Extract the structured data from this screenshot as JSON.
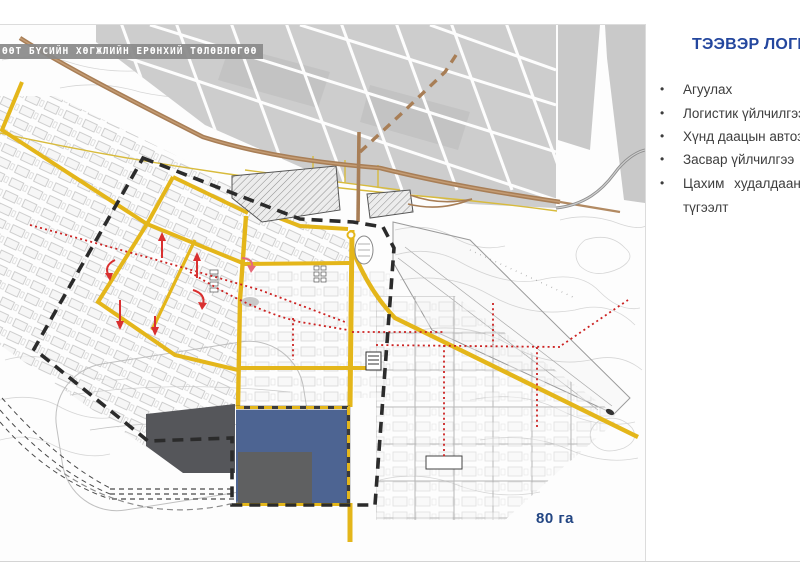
{
  "overlay_label": "ӨӨТ БҮСИЙН ХӨГЖЛИЙН ЕРӨНХИЙ ТӨЛӨВЛӨГӨӨ",
  "panel": {
    "title": "ТЭЭВЭР ЛОГИСТИК",
    "bullet_char": "•",
    "bullets": [
      {
        "label": "Агуулах"
      },
      {
        "label": "Логистик үйлчилгээ"
      },
      {
        "label": "Хүнд даацын автозам"
      },
      {
        "label": "Засвар үйлчилгээ"
      },
      {
        "label": "Цахим худалдааны",
        "continuation": "түгээлт"
      }
    ]
  },
  "map": {
    "area_label": "80 га",
    "colors": {
      "main_road_yellow": "#e4b61a",
      "highway_brown": "#a87e56",
      "boundary_dash": "#2b2b2b",
      "highlight_parcel_blue": "#4d6492",
      "dark_parcel_gray": "#55565a",
      "industrial_gray": "#cdcdcd",
      "route_red": "#cc2222"
    }
  }
}
